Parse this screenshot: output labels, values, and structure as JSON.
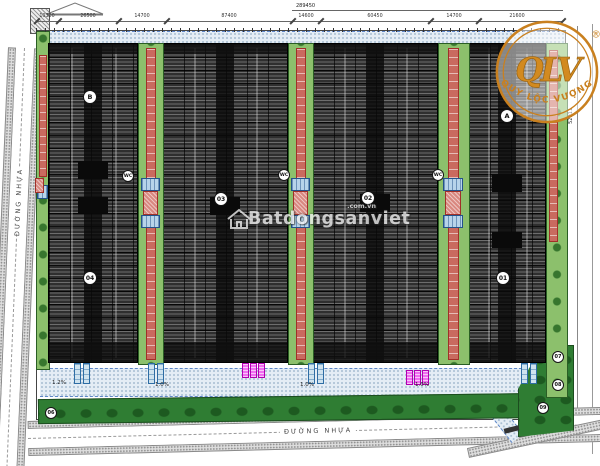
{
  "watermark": {
    "name": "Batdongsanviet",
    "domain": ".com.vn"
  },
  "logo": {
    "monogram": "QLV",
    "tagline": "QUY LỘC VƯỢNG",
    "registered": "®"
  },
  "roads": {
    "left_name": "ĐƯỜNG NHỰA",
    "bottom_name": "ĐƯỜNG NHỰA"
  },
  "dimensions": {
    "overall_top": "289450",
    "top_segments": [
      "10300",
      "26500",
      "14700",
      "87400",
      "14600",
      "60450",
      "14700",
      "21600"
    ],
    "right_side": "52911"
  },
  "building_labels": {
    "a": "A",
    "b": "B",
    "n01": "01",
    "n02": "02",
    "n03": "03",
    "n04": "04"
  },
  "site_markers": {
    "wc": "WC",
    "n06": "06",
    "n07": "07",
    "n08": "08",
    "n09": "09"
  },
  "slope_labels": {
    "primary": "1.2%",
    "secondary": "1.0%"
  },
  "colors": {
    "accent_orange": "#C9801F",
    "building_fill": "#2F2F2F",
    "green_strip": "#8CC06C",
    "buffer_green": "#2F7D33",
    "red_canopy": "#C96A5F",
    "road_edge_blue": "#5F87C9",
    "marker_magenta": "#F06DF0"
  }
}
